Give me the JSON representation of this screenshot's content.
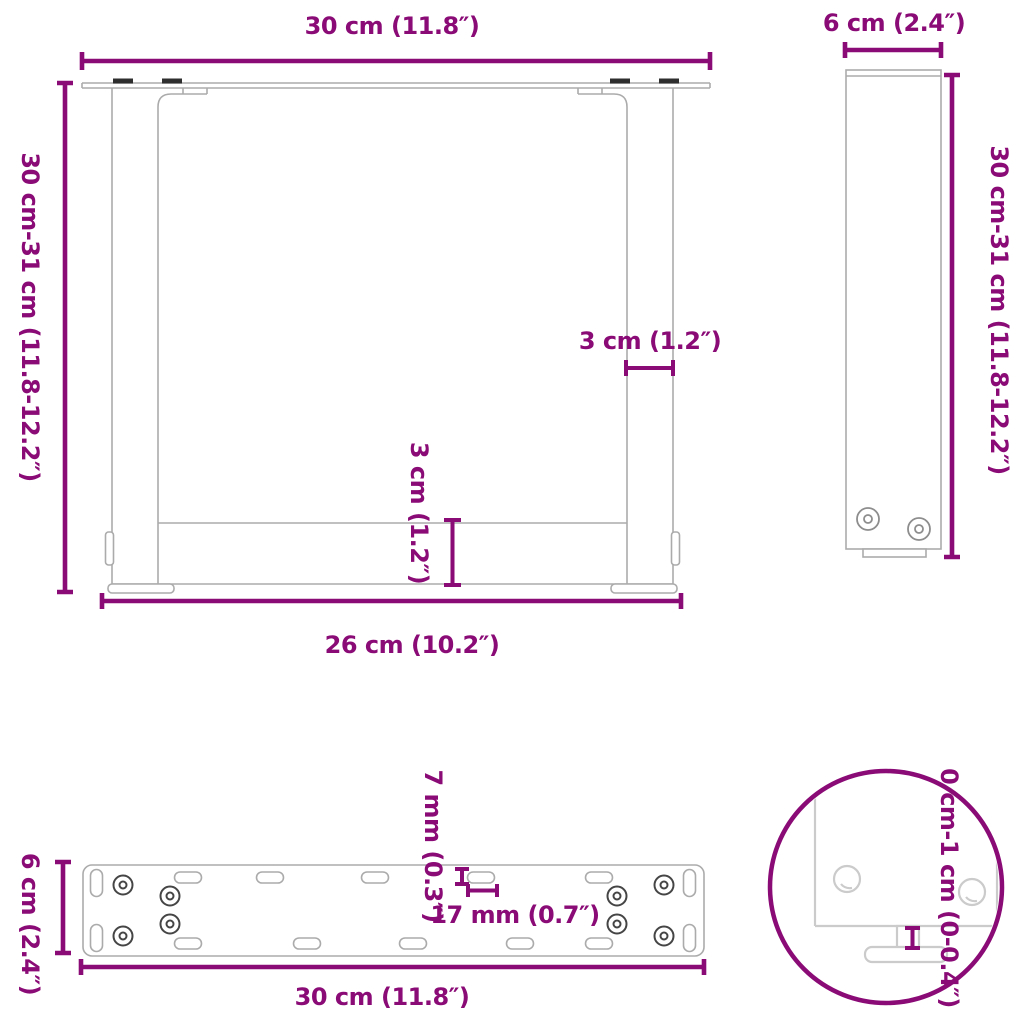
{
  "colors": {
    "dim": "#8A0A76",
    "outline": "#ABABAB",
    "outlineLight": "#CBCBCB",
    "dark": "#2E2E2E",
    "hole": "#454545"
  },
  "front_view": {
    "width_label": "30 cm (11.8″)",
    "height_label": "30 cm-31 cm (11.8-12.2″)",
    "leg_thickness_label": "3 cm (1.2″)",
    "crossbar_height_label": "3 cm (1.2″)",
    "inner_width_label": "26 cm (10.2″)"
  },
  "side_view": {
    "depth_label": "6 cm (2.4″)",
    "height_label": "30 cm-31 cm (11.8-12.2″)"
  },
  "top_view": {
    "depth_label": "6 cm (2.4″)",
    "width_label": "30 cm (11.8″)",
    "hole_width_label": "7 mm (0.3″)",
    "hole_length_label": "17 mm (0.7″)"
  },
  "detail_view": {
    "adjustable_range_label": "0 cm-1 cm (0-0.4″)"
  }
}
